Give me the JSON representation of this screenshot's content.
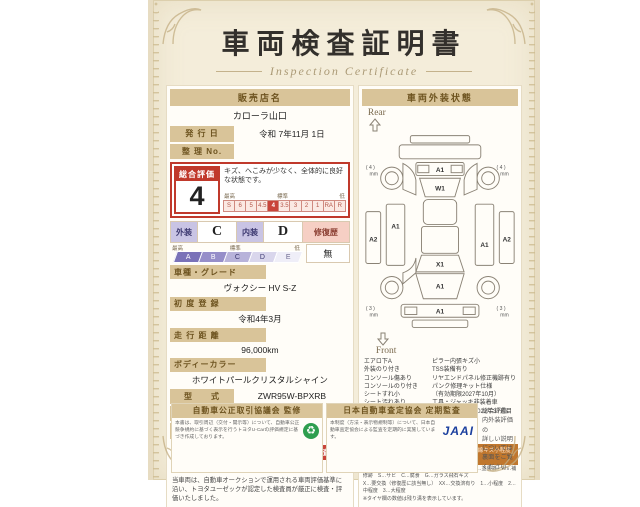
{
  "title": "車両検査証明書",
  "subtitle": "Inspection Certificate",
  "dealer": {
    "label": "販売店名",
    "value": "カローラ山口"
  },
  "issue": {
    "label": "発 行 日",
    "value": "令和 7年11月 1日"
  },
  "ref_no": {
    "label": "整 理 No.",
    "value": ""
  },
  "overall": {
    "label": "総合評価",
    "score": "4",
    "comment": "キズ、へこみが少なく、全体的に良好な状態です。",
    "scale_best": "最高",
    "scale_std": "標準",
    "scale_low": "低",
    "scale": [
      "S",
      "6",
      "5",
      "4.5",
      "4",
      "3.5",
      "3",
      "2",
      "1",
      "RA",
      "R"
    ]
  },
  "exterior": {
    "label": "外装",
    "value": "C"
  },
  "interior": {
    "label": "内装",
    "value": "D"
  },
  "grade_scale": [
    "A",
    "B",
    "C",
    "D",
    "E"
  ],
  "grade_best": "最高",
  "grade_std": "標準",
  "grade_low": "低",
  "repair": {
    "label": "修復歴",
    "value": "無"
  },
  "fields": [
    {
      "label": "車種・グレード",
      "value": "ヴォクシー HV S-Z"
    },
    {
      "label": "初 度 登 録",
      "value": "令和4年3月"
    },
    {
      "label": "走 行 距 離",
      "value": "96,000km"
    },
    {
      "label": "ボディーカラー",
      "value": "ホワイトパールクリスタルシャイン"
    }
  ],
  "inline_fields": [
    {
      "label": "型　　式",
      "value": "ZWR95W-BPXRB"
    },
    {
      "label": "車 台 番 号",
      "value": "XXXXXXX386"
    },
    {
      "label": "エ ン ジ ン",
      "value": "ハイブリッド"
    }
  ],
  "inspector": {
    "brand": "TOYOTA",
    "badge": "トヨタ認定車両検査員",
    "id": "XXXXXX"
  },
  "disclaimer": "当車両は、自動車オークションで運用される車両評価基準に沿い、トヨタユーゼックが認定した検査員が厳正に検査・評価いたしました。",
  "exterior_panel": {
    "header": "車両外装状態",
    "rear_label": "Rear",
    "front_label": "Front",
    "marks": {
      "rear_gate": "A1",
      "rear_window": "W1",
      "left_side": "A1",
      "left_outer": "A2",
      "right_side": "A1",
      "right_outer": "A2",
      "windshield": "X1",
      "hood": "A1",
      "front_bumper": "A1"
    },
    "tires": {
      "rear": "( 4 )",
      "front": "( 3 )",
      "unit": "mm"
    },
    "notes_left": [
      "エアロ下A",
      "外装のり付き",
      "コンソール傷あり",
      "コンソールのり付き",
      "シートすれ小",
      "シート汚れあり",
      "室内内張キズあり",
      "ドア内張キズあり",
      "荷室内張キズあり",
      "ハンドルすれあり"
    ],
    "notes_right": [
      "ピラー内張キズ小",
      "TSS装備有り",
      "リヤエンドパネル修正機跡有り",
      "パンク修理キット仕様",
      "（有効期限2027年10月）",
      "工具・ジャッキ非装着車",
      "タイヤ製造年月2022年37週目"
    ],
    "legend_header": "車両外装状態の表示記号について",
    "legend_example": "（例）A1＝線キズ小程度有り",
    "legend_lines": "A…線キズ跡　U…ヘコミ跡　B…キズヘコミ跡　P…塗装済　W…補修跡　S…サビ　C…腐食　G…ガラス飛石キズ\nX…要交換（修復歴に該当無し）　XX…交換済有り　1…小程度　2…中程度　3…大程度\n※タイヤ欄の数値は残り溝を表示しています。"
  },
  "footer": {
    "left_box": {
      "title": "自動車公正取引協議会 監修",
      "text": "本書は、取引周辺（交付・開示等）について、自動車公正競争規約に基づく表示を行うトヨタU-Carの評価規定に基づき作成しております。",
      "logo_glyph": "♻"
    },
    "right_box": {
      "title": "日本自動車査定協会 定期監査",
      "text": "本制度（方法・表示物規制等）について、日本自動車査定協会による監査を定期的に実施しています。",
      "logo": "JAAI"
    },
    "note": "総合評価、内外装評価の\n詳しい説明については\n裏面をご覧ください。"
  }
}
